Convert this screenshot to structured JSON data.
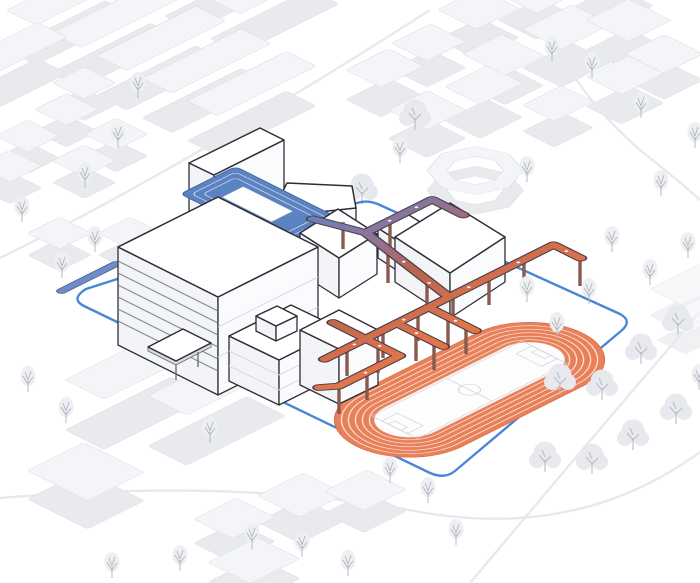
{
  "meta": {
    "title": "School campus site axonometric diagram",
    "subject": "Perspective axonometric illustration of a school campus inside a blue site boundary, surrounded by a light grey context city with trees",
    "diagram_type": "architectural-axonometric"
  },
  "palette": {
    "background": "#ffffff",
    "site_boundary": "#4a86d8",
    "courtyard_terraces_blue": "#5b83c1",
    "walkway_gradient_start_blue": "#5b82c4",
    "walkway_gradient_mid_purple": "#96708f",
    "walkway_gradient_end_red": "#e2744b",
    "walkway_outline": "#4a3f46",
    "running_track_orange": "#e8815a",
    "campus_building_fill": "#ffffff",
    "campus_building_outline": "#2e2e36",
    "context_building_wall": "#e8eaee",
    "context_building_roof": "#f4f5f8",
    "tree_line": "#b6bac2",
    "soccer_field_lines": "#ccd1da"
  },
  "elements": {
    "site_boundary": "blue site boundary line",
    "courtyard": "stepped blue courtyard terraces",
    "walkways": "elevated circulation loop on columns, gradient blue to red",
    "track": "orange 6-lane running track with soccer field",
    "louver_building": "slab building with horizontal louvers",
    "gym": "white box building beside the track",
    "context": "surrounding city blocks and street trees"
  }
}
